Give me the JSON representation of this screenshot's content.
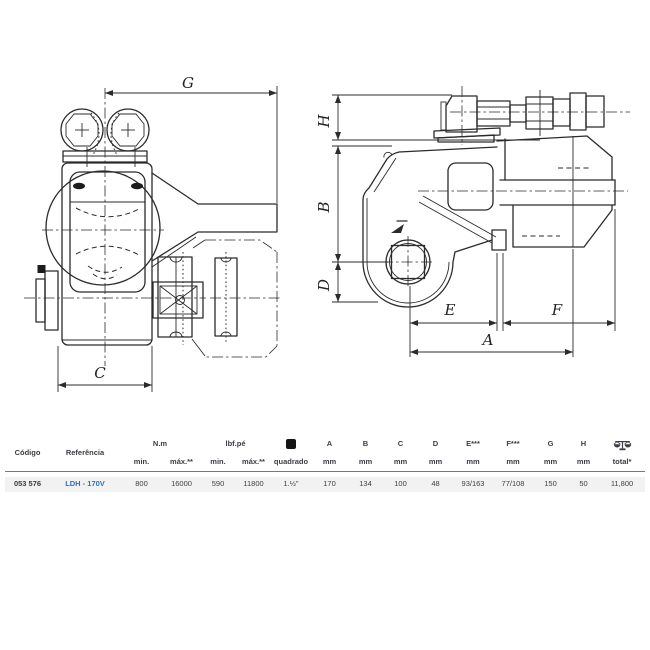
{
  "diagram": {
    "dims": {
      "g": "G",
      "c": "C",
      "h": "H",
      "b": "B",
      "d": "D",
      "e": "E",
      "f": "F",
      "a": "A"
    }
  },
  "table": {
    "headers": {
      "codigo": "Código",
      "referencia": "Referência",
      "nm": "N.m",
      "lbfpe": "lbf.pé",
      "min_nm": "min.",
      "max_nm": "máx.**",
      "min_lbf": "min.",
      "max_lbf": "máx.**",
      "quadrado": "quadrado",
      "square_icon": "square-drive-icon",
      "a": "A",
      "b": "B",
      "c": "C",
      "d": "D",
      "e": "E***",
      "f": "F***",
      "g": "G",
      "h": "H",
      "mm": "mm",
      "weight_icon": "weight-scale-icon",
      "total": "total*"
    },
    "row": {
      "codigo": "053 576",
      "referencia": "LDH - 170V",
      "nm_min": "800",
      "nm_max": "16000",
      "lbf_min": "590",
      "lbf_max": "11800",
      "quadrado": "1.½\"",
      "a": "170",
      "b": "134",
      "c": "100",
      "d": "48",
      "e": "93/163",
      "f": "77/108",
      "g": "150",
      "h": "50",
      "total": "11,800"
    }
  },
  "colors": {
    "accent_blue": "#2e75b6",
    "header_rule_blue": "#3d85c8",
    "row_bg": "#f2f2f2",
    "ink": "#2b2b2b",
    "header_text": "#3c3c44"
  }
}
